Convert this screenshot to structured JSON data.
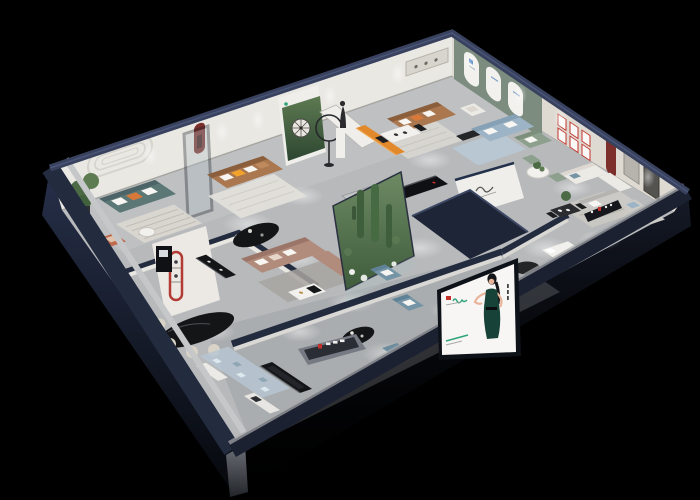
{
  "palette": {
    "bg": "#000000",
    "roof_edge": "#38425e",
    "wall_top": "#232b3e",
    "wall_face_nw": "#eae8e3",
    "wall_face_ne": "#ded9d1",
    "wall_exterior_top": "#27304a",
    "wall_exterior_bottom": "#05070b",
    "corner_light": "#6e7278",
    "floor": "#b7b9bb",
    "floor_light": "#c9cacb",
    "floor_shadow": "#8f9195",
    "inner_wall_face": "#d9d7d3",
    "partition_white": "#efeeea",
    "green_wall": "#7c8d80",
    "arch_white": "#f2f1ed",
    "red_arch": "#7c2f2b",
    "forest_light": "#5d7a52",
    "forest_dark": "#2c4630",
    "logo_green": "#2fa47b",
    "logo_red": "#c0322a",
    "blue_logo": "#2f6fbd",
    "navy_roof": "#1e2536",
    "navy_roof_edge": "#3d4964",
    "glass": "#aebfc4",
    "terrarium_light": "#6d8a64",
    "terrarium_dark": "#3f5c3c",
    "cactus": "#3f5e3c",
    "plant": "#4c6b45",
    "sofa_teal": "#5b7876",
    "sofa_teal_dark": "#4c6467",
    "sofa_brown": "#aa774f",
    "sofa_brown_dark": "#8c5f3c",
    "sofa_taupe": "#b18b7b",
    "sofa_taupe_dark": "#9b7668",
    "sofa_blue": "#9db4c6",
    "sofa_blue_dark": "#86a0b5",
    "sofa_green": "#8da08d",
    "sofa_white": "#eceae5",
    "sofa_gray": "#cbcac6",
    "chair_steel": "#7595a6",
    "chair_steel_dark": "#5f8296",
    "chair_terracotta": "#bf6a4d",
    "accent_orange": "#e2892b",
    "pillow_white": "#f7f6f3",
    "pillow_orange": "#d8793a",
    "pillow_yellow": "#f2a32c",
    "rug_light": "#dbd8d2",
    "rug_warm": "#e3e1db",
    "rug_gray": "#a8a5a0",
    "rug_blue": "#b9c9d6",
    "rug_pixel": "#b7c6d2",
    "table_black": "#141517",
    "table_white": "#f2f1ee",
    "cabinet_black": "#101114",
    "billboard_white": "#f7f6f4",
    "billboard_frame": "#0d1118",
    "dress": "#174238",
    "hair": "#141519",
    "skin": "#e8b49a",
    "sign_face": "#757a83",
    "sign_recess": "#2a2d34",
    "shelf_red": "#b23b33",
    "spotlight": "#ffffff"
  }
}
